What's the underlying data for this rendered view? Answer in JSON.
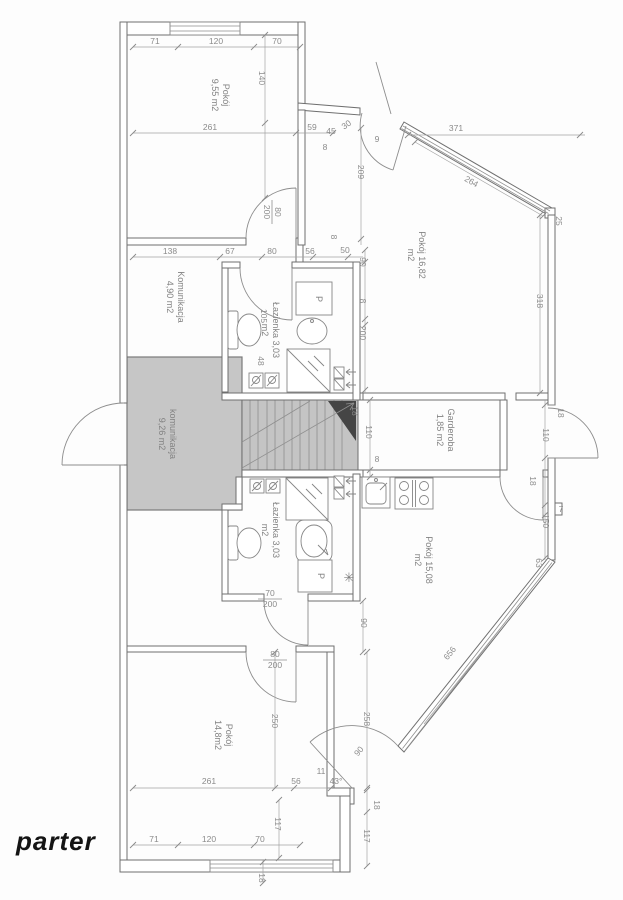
{
  "plan": {
    "title": "parter",
    "rooms": {
      "pokoj_nw": {
        "name": "Pokój",
        "area": "9,55 m2"
      },
      "pokoj_ne": {
        "name": "Pokój 16,82",
        "area": "m2"
      },
      "komunikacja_hall": {
        "name": "Komunikacja",
        "area": "4,90 m2"
      },
      "lazienka_gorna": {
        "name": "Łazienka 3,03",
        "area": "m2"
      },
      "komunikacja_stair": {
        "name": "komunikacja",
        "area": "9,26 m2"
      },
      "garderoba": {
        "name": "Garderoba",
        "area": "1,85 m2"
      },
      "lazienka_dolna": {
        "name": "Łazienka 3,03",
        "area": "m2"
      },
      "pokoj_se": {
        "name": "Pokój 15,08",
        "area": "m2"
      },
      "pokoj_sw": {
        "name": "Pokój",
        "area": "14,8m2"
      }
    },
    "fixtures": {
      "washer_label": "P",
      "boiler_symbol": "✳"
    },
    "doors": {
      "top": {
        "w": "80",
        "h": "200"
      },
      "bath": {
        "w": "70",
        "h": "200"
      },
      "sw": {
        "w": "80",
        "h": "200"
      }
    },
    "dims": {
      "d1": "71",
      "d2": "120",
      "d3": "70",
      "d4": "140",
      "d5": "261",
      "d6": "59",
      "d7": "45",
      "d8": "30",
      "d9": "9",
      "d10": "8",
      "d11": "209",
      "d12": "371",
      "d13": "264",
      "d14": "25",
      "d15": "318",
      "d16": "138",
      "d17": "67",
      "d18": "80",
      "d19": "56",
      "d20": "50",
      "d21": "90",
      "d22": "8",
      "d23": "8",
      "d24": "200",
      "d25": "105",
      "d26": "48",
      "d27": "18",
      "d28": "110",
      "d29": "8",
      "d30": "18",
      "d31": "110",
      "d32": "18",
      "d33": "7",
      "d34": "150",
      "d35": "63",
      "d36": "656",
      "d37": "90",
      "d38": "250",
      "d39": "258",
      "d40": "90",
      "d41": "43°",
      "d42": "11",
      "d43": "56",
      "d44": "261",
      "d45": "18",
      "d46": "117",
      "d47": "117",
      "d48": "18",
      "d49": "71",
      "d50": "120",
      "d51": "70"
    },
    "colors": {
      "paper": "#fdfdfd",
      "gray_room": "#c6c6c6",
      "stair_fill": "#c4c4c4",
      "stair_dark": "#454545"
    }
  }
}
